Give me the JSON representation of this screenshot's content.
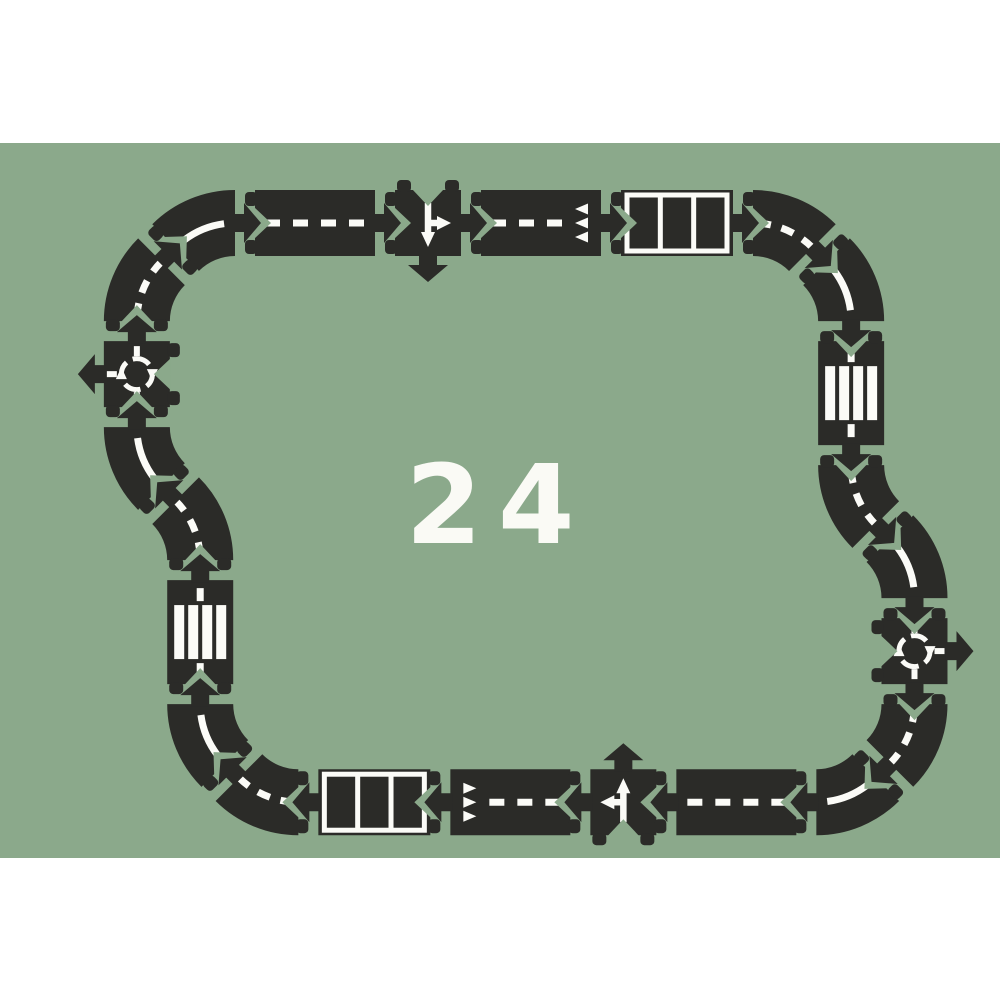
{
  "center_label": "24",
  "colors": {
    "page_background": "#ffffff",
    "mat_green": "#8BA98B",
    "road_black": "#2B2B28",
    "marking_white": "#FBFBF7",
    "label_white": "#FAFAF5"
  },
  "mat": {
    "top": 143,
    "height": 715
  },
  "geometry": {
    "road_width": 66,
    "curve_radius": 84,
    "connector_gap": 20,
    "start": {
      "x": 255,
      "y": 223,
      "angle": 0
    }
  },
  "track": {
    "piece_count": 24,
    "pieces": [
      {
        "type": "straight",
        "marking": "dashed",
        "length": 120
      },
      {
        "type": "junction",
        "size": 66
      },
      {
        "type": "straight",
        "marking": "teeth",
        "length": 120
      },
      {
        "type": "parking",
        "length": 112
      },
      {
        "type": "curve",
        "dir": "right",
        "marking": "dashed"
      },
      {
        "type": "curve",
        "dir": "right",
        "marking": "solid"
      },
      {
        "type": "crosswalk",
        "length": 104
      },
      {
        "type": "curve",
        "dir": "left",
        "marking": "dashed"
      },
      {
        "type": "curve",
        "dir": "right",
        "marking": "solid"
      },
      {
        "type": "roundabout",
        "size": 66
      },
      {
        "type": "curve",
        "dir": "right",
        "marking": "dashed"
      },
      {
        "type": "curve",
        "dir": "right",
        "marking": "solid"
      },
      {
        "type": "straight",
        "marking": "dashed",
        "length": 120
      },
      {
        "type": "junction",
        "size": 66
      },
      {
        "type": "straight",
        "marking": "teeth",
        "length": 120
      },
      {
        "type": "parking",
        "length": 112
      },
      {
        "type": "curve",
        "dir": "right",
        "marking": "dashed"
      },
      {
        "type": "curve",
        "dir": "right",
        "marking": "solid"
      },
      {
        "type": "crosswalk",
        "length": 104
      },
      {
        "type": "curve",
        "dir": "left",
        "marking": "dashed"
      },
      {
        "type": "curve",
        "dir": "right",
        "marking": "solid"
      },
      {
        "type": "roundabout",
        "size": 66
      },
      {
        "type": "curve",
        "dir": "right",
        "marking": "dashed"
      },
      {
        "type": "curve",
        "dir": "right",
        "marking": "solid"
      }
    ]
  }
}
